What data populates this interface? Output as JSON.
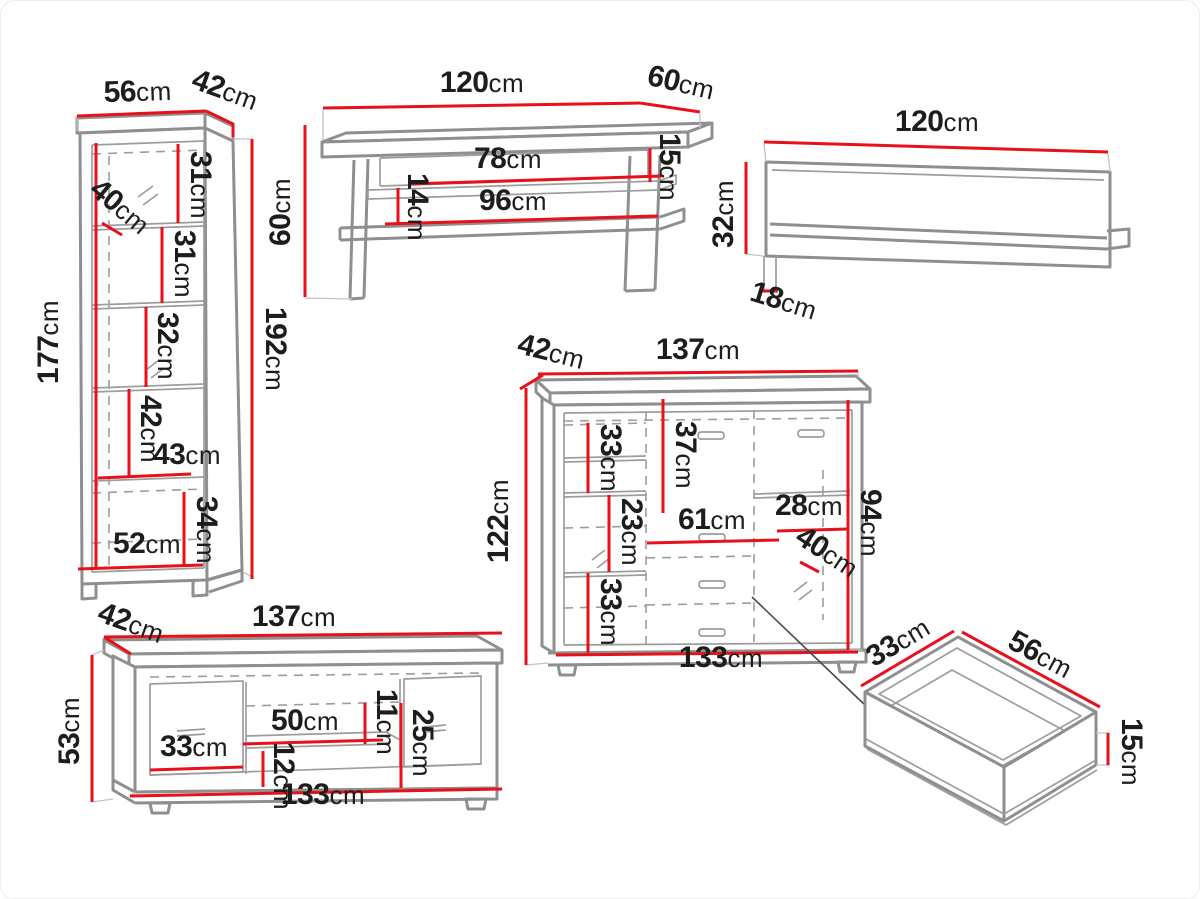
{
  "diagram_title": "furniture-set-dimensions",
  "unit_system": "cm",
  "colors": {
    "outline": "#8f8f8f",
    "dimension_line": "#e8101b",
    "label_text": "#1d1d1b",
    "background": "#ffffff"
  },
  "items": {
    "vitrine": {
      "name": "tall-display-cabinet",
      "labels": {
        "width": {
          "value": "56",
          "unit": "cm"
        },
        "depth": {
          "value": "42",
          "unit": "cm"
        },
        "inner_diagonal": {
          "value": "40",
          "unit": "cm"
        },
        "shelf_1": {
          "value": "31",
          "unit": "cm"
        },
        "shelf_2": {
          "value": "31",
          "unit": "cm"
        },
        "shelf_3": {
          "value": "32",
          "unit": "cm"
        },
        "shelf_4": {
          "value": "42",
          "unit": "cm"
        },
        "inner_width": {
          "value": "43",
          "unit": "cm"
        },
        "bottom_section": {
          "value": "34",
          "unit": "cm"
        },
        "bottom_width": {
          "value": "52",
          "unit": "cm"
        },
        "inner_height": {
          "value": "177",
          "unit": "cm"
        },
        "height": {
          "value": "192",
          "unit": "cm"
        }
      }
    },
    "coffee_table": {
      "name": "coffee-table",
      "labels": {
        "width": {
          "value": "120",
          "unit": "cm"
        },
        "depth": {
          "value": "60",
          "unit": "cm"
        },
        "height": {
          "value": "60",
          "unit": "cm"
        },
        "opening_width": {
          "value": "78",
          "unit": "cm"
        },
        "lower_shelf_width": {
          "value": "96",
          "unit": "cm"
        },
        "top_gap": {
          "value": "15",
          "unit": "cm"
        },
        "shelf_gap": {
          "value": "14",
          "unit": "cm"
        }
      }
    },
    "wall_shelf": {
      "name": "wall-shelf",
      "labels": {
        "width": {
          "value": "120",
          "unit": "cm"
        },
        "height": {
          "value": "32",
          "unit": "cm"
        },
        "depth": {
          "value": "18",
          "unit": "cm"
        }
      }
    },
    "sideboard": {
      "name": "highboard-sideboard",
      "labels": {
        "depth": {
          "value": "42",
          "unit": "cm"
        },
        "width": {
          "value": "137",
          "unit": "cm"
        },
        "height": {
          "value": "122",
          "unit": "cm"
        },
        "front_height": {
          "value": "94",
          "unit": "cm"
        },
        "top_left_shelf": {
          "value": "33",
          "unit": "cm"
        },
        "top_section": {
          "value": "37",
          "unit": "cm"
        },
        "middle_left": {
          "value": "23",
          "unit": "cm"
        },
        "drawer_width": {
          "value": "61",
          "unit": "cm"
        },
        "right_section": {
          "value": "28",
          "unit": "cm"
        },
        "inner_diagonal": {
          "value": "40",
          "unit": "cm"
        },
        "bottom_left_shelf": {
          "value": "33",
          "unit": "cm"
        },
        "inner_width": {
          "value": "133",
          "unit": "cm"
        }
      }
    },
    "tv_stand": {
      "name": "tv-stand",
      "labels": {
        "depth": {
          "value": "42",
          "unit": "cm"
        },
        "width": {
          "value": "137",
          "unit": "cm"
        },
        "height": {
          "value": "53",
          "unit": "cm"
        },
        "door_width": {
          "value": "33",
          "unit": "cm"
        },
        "shelf_width": {
          "value": "50",
          "unit": "cm"
        },
        "upper_gap": {
          "value": "11",
          "unit": "cm"
        },
        "lower_gap": {
          "value": "12",
          "unit": "cm"
        },
        "niche_height": {
          "value": "25",
          "unit": "cm"
        },
        "inner_width": {
          "value": "133",
          "unit": "cm"
        }
      }
    },
    "drawer": {
      "name": "drawer-detail",
      "labels": {
        "depth": {
          "value": "33",
          "unit": "cm"
        },
        "width": {
          "value": "56",
          "unit": "cm"
        },
        "height": {
          "value": "15",
          "unit": "cm"
        }
      }
    }
  }
}
